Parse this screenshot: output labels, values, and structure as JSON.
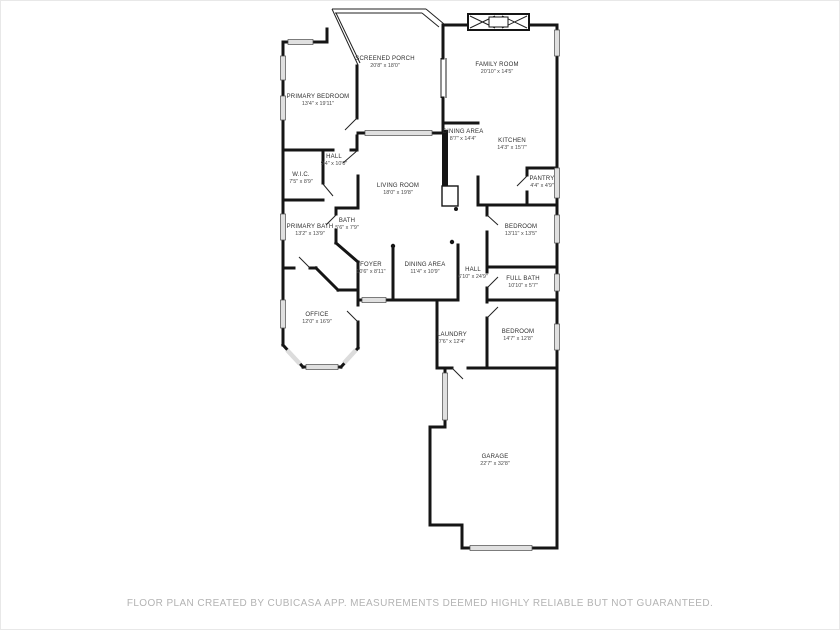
{
  "page": {
    "background": "#ffffff"
  },
  "colors": {
    "wall": "#151515",
    "window": "#e0e0e0",
    "footer_text": "#b3b3b3"
  },
  "footer": {
    "text": "FLOOR PLAN CREATED BY CUBICASA APP. MEASUREMENTS DEEMED HIGHLY RELIABLE BUT NOT GUARANTEED."
  },
  "floor_plan": {
    "rooms": [
      {
        "id": "screened-porch",
        "name": "SCREENED PORCH",
        "dims": "20'8\" x 18'0\""
      },
      {
        "id": "family-room",
        "name": "FAMILY ROOM",
        "dims": "20'10\" x 14'5\""
      },
      {
        "id": "primary-bedroom",
        "name": "PRIMARY BEDROOM",
        "dims": "13'4\" x 19'11\""
      },
      {
        "id": "dining-area-upper",
        "name": "DINING AREA",
        "dims": "8'7\" x 14'4\""
      },
      {
        "id": "kitchen",
        "name": "KITCHEN",
        "dims": "14'3\" x 15'7\""
      },
      {
        "id": "hall-upper",
        "name": "HALL",
        "dims": "9'4\" x 10'0\""
      },
      {
        "id": "wic",
        "name": "W.I.C.",
        "dims": "7'5\" x 8'9\""
      },
      {
        "id": "pantry",
        "name": "PANTRY",
        "dims": "4'4\" x 4'9\""
      },
      {
        "id": "living-room",
        "name": "LIVING ROOM",
        "dims": "18'0\" x 19'8\""
      },
      {
        "id": "primary-bath",
        "name": "PRIMARY BATH",
        "dims": "13'2\" x 13'9\""
      },
      {
        "id": "bath",
        "name": "BATH",
        "dims": "5'6\" x 7'9\""
      },
      {
        "id": "bedroom-1",
        "name": "BEDROOM",
        "dims": "13'11\" x 13'5\""
      },
      {
        "id": "foyer",
        "name": "FOYER",
        "dims": "10'6\" x 8'11\""
      },
      {
        "id": "dining-area",
        "name": "DINING AREA",
        "dims": "11'4\" x 10'9\""
      },
      {
        "id": "hall-lower",
        "name": "HALL",
        "dims": "6'10\" x 24'9\""
      },
      {
        "id": "full-bath",
        "name": "FULL BATH",
        "dims": "10'10\" x 5'7\""
      },
      {
        "id": "office",
        "name": "OFFICE",
        "dims": "12'0\" x 16'9\""
      },
      {
        "id": "laundry",
        "name": "LAUNDRY",
        "dims": "7'6\" x 12'4\""
      },
      {
        "id": "bedroom-2",
        "name": "BEDROOM",
        "dims": "14'7\" x 12'8\""
      },
      {
        "id": "garage",
        "name": "GARAGE",
        "dims": "22'7\" x 32'8\""
      }
    ]
  }
}
